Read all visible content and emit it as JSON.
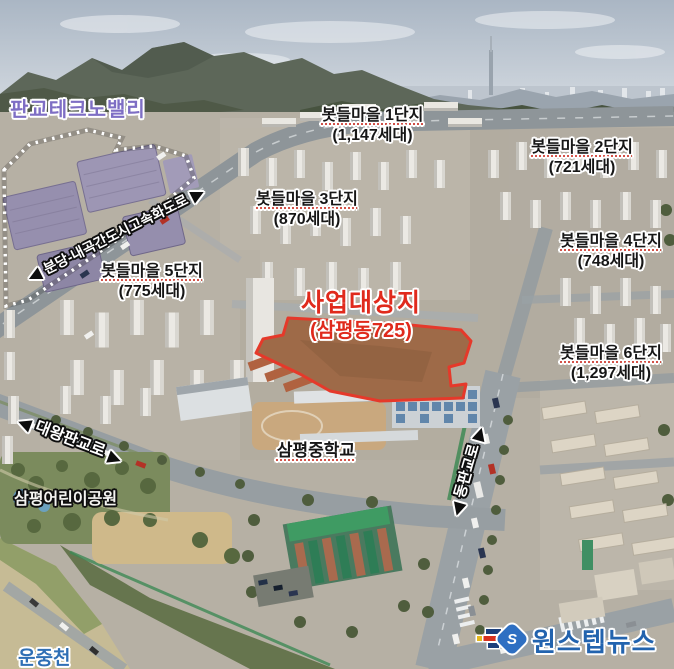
{
  "labels": {
    "techno_valley": "판교테크노밸리",
    "villages": [
      {
        "name": "봇들마을 1단지",
        "units": "(1,147세대)"
      },
      {
        "name": "봇들마을 2단지",
        "units": "(721세대)"
      },
      {
        "name": "봇들마을 3단지",
        "units": "(870세대)"
      },
      {
        "name": "봇들마을 4단지",
        "units": "(748세대)"
      },
      {
        "name": "봇들마을 5단지",
        "units": "(775세대)"
      },
      {
        "name": "봇들마을 6단지",
        "units": "(1,297세대)"
      }
    ],
    "site": {
      "title": "사업대상지",
      "subtitle": "(삼평동725)"
    },
    "roads": {
      "expressway": "분당-내곡간도시고속화도로",
      "daewang": "대왕판교로",
      "dongpangyo": "동판교로"
    },
    "places": {
      "school": "삼평중학교",
      "park": "삼평어린이공원",
      "stream": "운중천"
    }
  },
  "watermark": {
    "text": "원스텝뉴스",
    "icon_letter": "S"
  },
  "icons": {
    "arrow_left": "◀",
    "arrow_right": "▶"
  },
  "colors": {
    "site_outline": "#e5392a",
    "site_text": "#e02a1c",
    "techno_text": "#7e6ec4",
    "stream_text": "#2f6fb5",
    "logo_blue": "#2263ae"
  }
}
